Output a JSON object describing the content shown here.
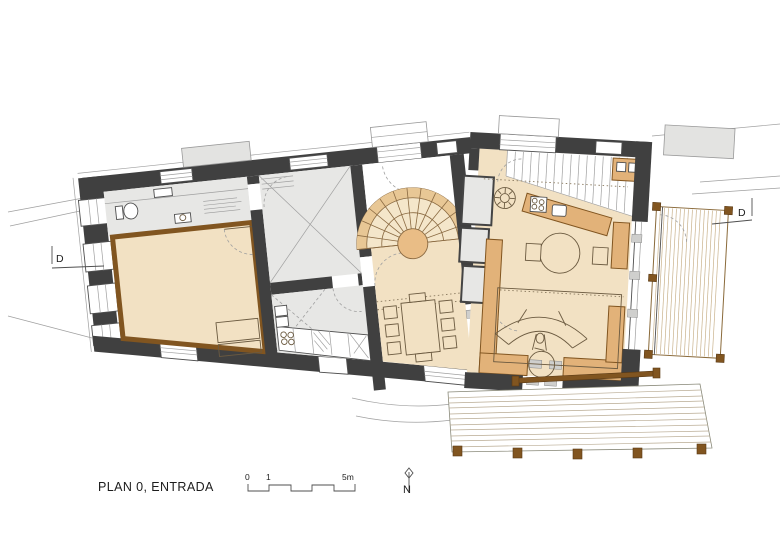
{
  "canvas": {
    "width": 780,
    "height": 552,
    "background": "#ffffff"
  },
  "palette": {
    "wall": "#404040",
    "floor": "#f2e1c3",
    "wood": "#e2b279",
    "wood_dark": "#815520",
    "gray_floor": "#e7e7e5",
    "fan": "#f4e6ca",
    "ring": "#e8c795",
    "newel": "#e9bd86",
    "white": "#ffffff",
    "line": "#4f4f4f",
    "line_light": "#a0a0a0",
    "deck_line": "#c9b28c",
    "plank_line": "#b9ab93",
    "canopy": "#e3e3e1",
    "sill": "#cfcfcd"
  },
  "labels": {
    "title": "PLAN 0, ENTRADA",
    "scale_0": "0",
    "scale_1": "1",
    "scale_5m": "5m",
    "north": "N",
    "section_left": "D",
    "section_right": "D"
  }
}
